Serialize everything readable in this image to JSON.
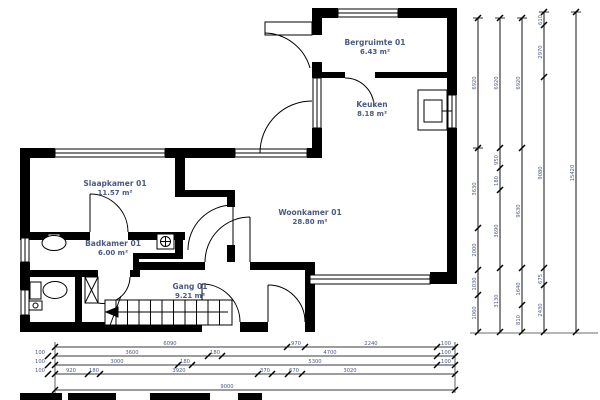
{
  "plan": {
    "title": "Begane grond plattegrond",
    "colors": {
      "wall": "#000000",
      "label": "#4a5a85",
      "dim_line": "#3a3a3a"
    },
    "rooms": {
      "bergruimte": {
        "name": "Bergruimte 01",
        "area": "6.43 m²"
      },
      "keuken": {
        "name": "Keuken",
        "area": "8.18 m²"
      },
      "slaapkamer": {
        "name": "Slaapkamer 01",
        "area": "11.57 m²"
      },
      "woonkamer": {
        "name": "Woonkamer 01",
        "area": "28.80 m²"
      },
      "badkamer": {
        "name": "Badkamer 01",
        "area": "6.00 m²"
      },
      "gang": {
        "name": "Gang 01",
        "area": "9.21 m²"
      }
    },
    "dimensions": {
      "bottom": {
        "row1": [
          "6090",
          "970",
          "2240",
          "100"
        ],
        "row2": [
          "100",
          "3600",
          "180",
          "4700",
          "100"
        ],
        "row3": [
          "100",
          "3000",
          "180",
          "5300",
          "100"
        ],
        "row4": [
          "100",
          "920",
          "180",
          "3920",
          "370",
          "670",
          "3020"
        ],
        "row5": [
          "9000"
        ]
      },
      "right": {
        "col1": [
          "6920",
          "3630",
          "2000",
          "1030",
          "1060"
        ],
        "col2": [
          "6920",
          "950",
          "180",
          "3690",
          "3130"
        ],
        "col3": [
          "6920",
          "9630",
          "1640",
          "810"
        ],
        "col4": [
          "610",
          "2970",
          "9080",
          "675",
          "2430"
        ],
        "col5": [
          "15420"
        ]
      }
    }
  }
}
